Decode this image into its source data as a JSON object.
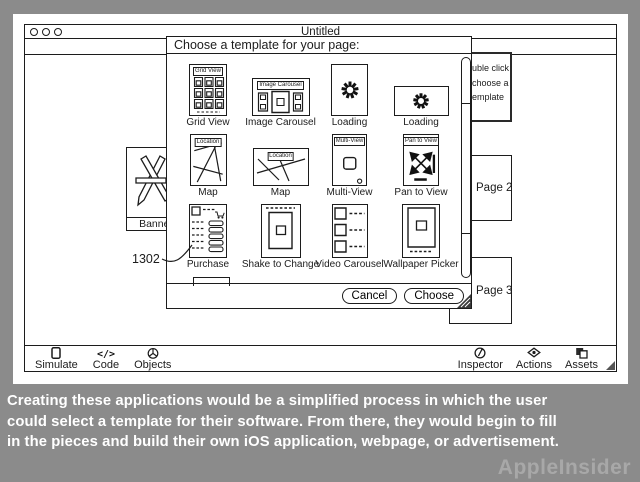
{
  "colors": {
    "background": "#8b8b8b",
    "ink": "#1c1c1c",
    "caption_text": "#ffffff",
    "watermark_text": "#a8a8a8"
  },
  "window": {
    "title": "Untitled",
    "traffic_lights": 3,
    "canvas": {
      "banner": {
        "label": "Banner",
        "icon": "appstore-pencil-a-icon"
      },
      "pages": [
        {
          "label": "Page 2"
        },
        {
          "label": "Page 3"
        }
      ],
      "hint_box": {
        "lines": [
          "uble click",
          "choose a",
          "emplate"
        ]
      },
      "annotation": {
        "label": "1302"
      }
    },
    "toolbar": {
      "code_glyph": "</>",
      "left": [
        {
          "label": "Simulate",
          "icon": "device-icon"
        },
        {
          "label": "Code",
          "icon": "code-icon"
        },
        {
          "label": "Objects",
          "icon": "object-sphere-icon"
        }
      ],
      "right": [
        {
          "label": "Inspector",
          "icon": "inspector-circle-icon"
        },
        {
          "label": "Actions",
          "icon": "actions-diamond-icon"
        },
        {
          "label": "Assets",
          "icon": "assets-layers-icon"
        }
      ]
    }
  },
  "dialog": {
    "title": "Choose a template for your page:",
    "templates": [
      {
        "label": "Grid View",
        "thumb_header": "Grid View",
        "kind": "grid-view"
      },
      {
        "label": "Image Carousel",
        "thumb_header": "Image Carousel",
        "kind": "image-carousel"
      },
      {
        "label": "Loading",
        "thumb_header": "",
        "kind": "loading-portrait"
      },
      {
        "label": "Loading",
        "thumb_header": "",
        "kind": "loading-landscape"
      },
      {
        "label": "Map",
        "thumb_header": "Location",
        "kind": "map-portrait"
      },
      {
        "label": "Map",
        "thumb_header": "Location",
        "kind": "map-landscape"
      },
      {
        "label": "Multi-View",
        "thumb_header": "Multi-View",
        "kind": "multi-view"
      },
      {
        "label": "Pan to View",
        "thumb_header": "Pan to View",
        "kind": "pan-to-view"
      },
      {
        "label": "Purchase",
        "thumb_header": "",
        "kind": "purchase"
      },
      {
        "label": "Shake to Change",
        "thumb_header": "",
        "kind": "shake-to-change"
      },
      {
        "label": "Video Carousel",
        "thumb_header": "",
        "kind": "video-carousel"
      },
      {
        "label": "Wallpaper Picker",
        "thumb_header": "",
        "kind": "wallpaper-picker"
      }
    ],
    "buttons": {
      "cancel": "Cancel",
      "choose": "Choose"
    }
  },
  "caption": {
    "lines": [
      "Creating these applications would be a simplified process in which the user",
      "could select a template for their software. From there, they would begin to fill",
      "in the pieces and build their own iOS application, webpage, or advertisement."
    ],
    "watermark": "AppleInsider"
  }
}
